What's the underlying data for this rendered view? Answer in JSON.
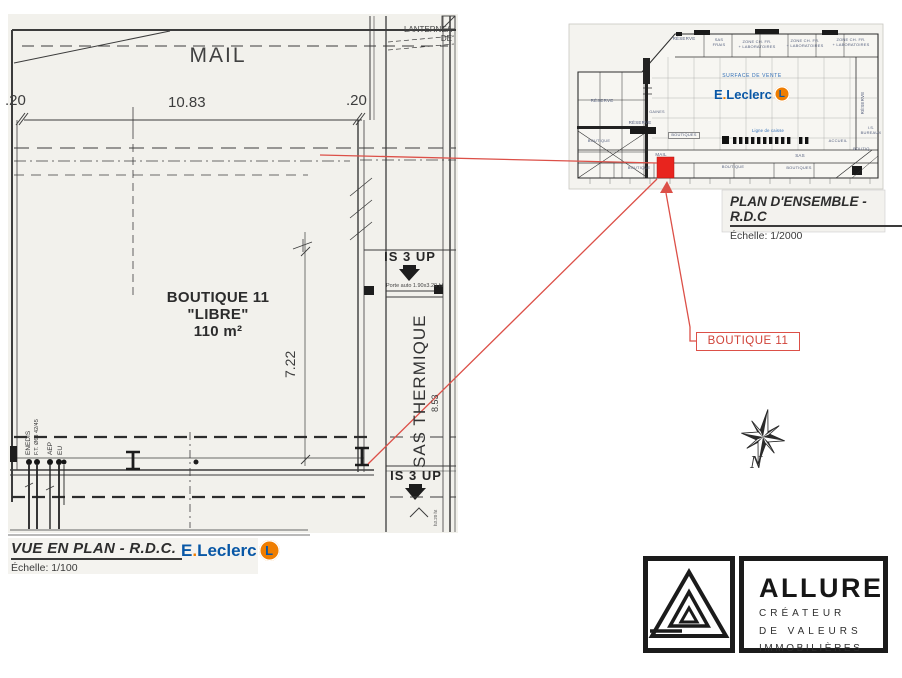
{
  "main_plan": {
    "mail": "MAIL",
    "lanterneau": "LANTERNEA\nDE",
    "dim_left": ".20",
    "dim_width": "10.83",
    "dim_right": ".20",
    "boutique": {
      "title": "BOUTIQUE 11",
      "status": "\"LIBRE\"",
      "area": "110 m²"
    },
    "dim_depth": "7.22",
    "is3up_top": "IS 3 UP",
    "porte_note": "Porte auto 1.90x3.20 ht",
    "sas_thermique": "SAS THERMIQUE",
    "dim_sas": "8.53",
    "is3up_bottom": "IS 3 UP",
    "utilities": [
      "ENEDIS",
      "F.T. Ø63 42/45",
      "AEP",
      "EU"
    ],
    "door_height_note": "h3.20 ht",
    "title": "VUE EN PLAN - R.D.C.",
    "scale": "Échelle: 1/100"
  },
  "leclerc": {
    "brand_e": "E",
    "brand_dot": ".",
    "brand_rest": "Leclerc",
    "l_badge": "L",
    "blue": "#0857a6",
    "orange": "#ef7d00"
  },
  "overview": {
    "labels": {
      "reserve_top": "RÉSERVE",
      "sas_frais": "SAS\nFRAIS",
      "zone1": "ZONE CH. FR.\n+ LABORATOIRES",
      "zone2": "ZONE CH. FR.\n+ LABORATOIRES",
      "zone3": "ZONE CH. FR.\n+ LABORATOIRES",
      "surface_vente": "SURFACE DE VENTE",
      "reserve_left": "RÉSERVE",
      "reserve_mid": "RÉSERVE",
      "gaines": "GAINES",
      "reserve_right": "RÉSERVE",
      "is_bureaux": "I.S.\nBUREAUX",
      "ligne_caisse": "Ligne de caisse",
      "accueil": "ACCUEIL",
      "mail": "MAIL",
      "sas": "SAS",
      "boutiques_mid": "BOUTIQUES",
      "boutique_left": "BOUTIQUE",
      "boutique_b1": "BOUTIQUE",
      "boutique_b2": "BOUTIQUE",
      "boutiques_b3": "BOUTIQUES",
      "boutiq_right": "BOUTIQ.",
      "title": "PLAN D'ENSEMBLE - R.D.C",
      "scale": "Échelle: 1/2000"
    }
  },
  "annotation": {
    "boutique_tag": "BOUTIQUE 11",
    "red": "#dc5048",
    "square_red": "#e8241e"
  },
  "compass": {
    "north": "N"
  },
  "allure": {
    "name": "ALLURE",
    "tagline": [
      "CRÉATEUR",
      "DE VALEURS",
      "IMMOBILIÈRES"
    ]
  }
}
